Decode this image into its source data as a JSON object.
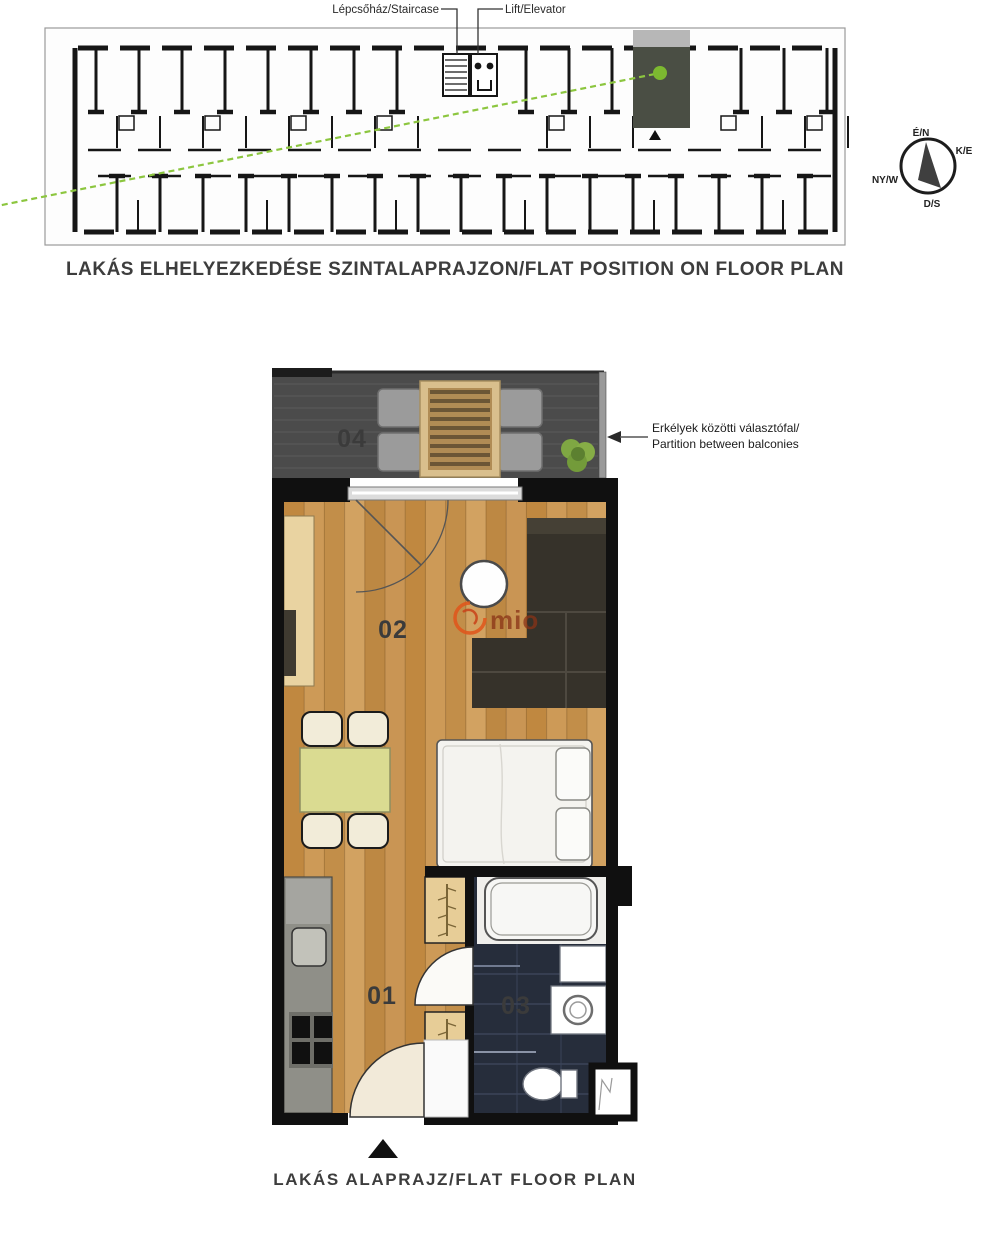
{
  "site_plan": {
    "staircase_label": "Lépcsőház/Staircase",
    "elevator_label": "Lift/Elevator",
    "caption": "LAKÁS ELHELYEZKEDÉSE SZINTALAPRAJZON/FLAT POSITION ON FLOOR PLAN",
    "compass": {
      "north": "É/N",
      "east": "K/E",
      "west": "NY/W",
      "south": "D/S"
    }
  },
  "flat_plan": {
    "caption": "LAKÁS ALAPRAJZ/FLAT FLOOR PLAN",
    "partition_note": {
      "line1": "Erkélyek közötti választófal/",
      "line2": "Partition between balconies"
    },
    "rooms": {
      "r01": "01",
      "r02": "02",
      "r03": "03",
      "r04": "04"
    },
    "watermark": "mio"
  },
  "colors": {
    "accent_green": "#8cc63f",
    "wall_black": "#101010",
    "wood_floor": "#c6914f",
    "balcony_deck": "#4b4b4b",
    "bathroom_tile": "#262d3b",
    "highlighted_unit": "#4a4e44",
    "watermark_orange": "#e0571c"
  }
}
